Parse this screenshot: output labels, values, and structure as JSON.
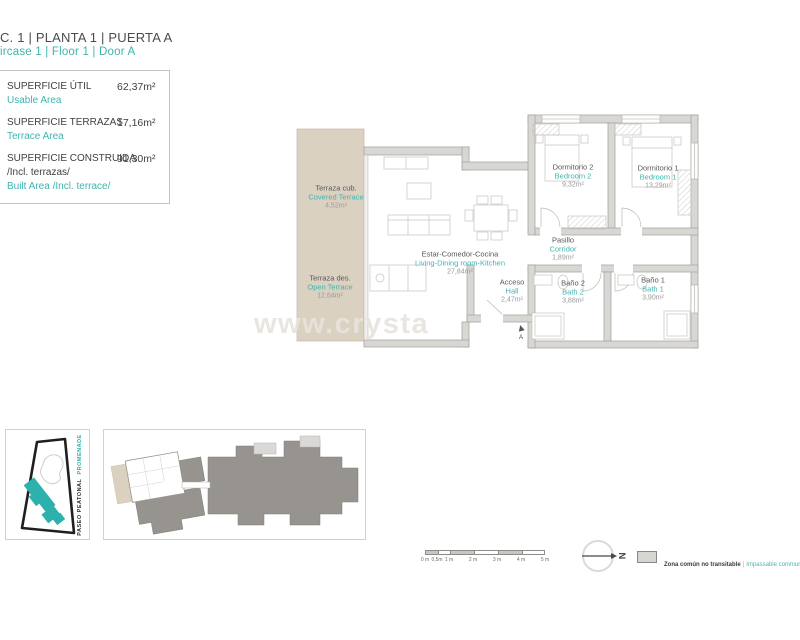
{
  "header": {
    "title_line_es": "C. 1 | PLANTA 1 | PUERTA A",
    "title_line_en": "ircase 1 | Floor 1 | Door A"
  },
  "summary": {
    "rows": [
      {
        "label_es": "SUPERFICIE ÚTIL",
        "label_en": "Usable Area",
        "value": "62,37m²"
      },
      {
        "label_es": "SUPERFICIE TERRAZAS",
        "label_en": "Terrace Area",
        "value": "17,16m²"
      },
      {
        "label_es": "SUPERFICIE CONSTRUIDA",
        "label_es2": "/Incl. terrazas/",
        "label_en": "Built Area /Incl. terrace/",
        "value": "91,30m²"
      }
    ]
  },
  "plan": {
    "rooms": [
      {
        "name_es": "Terraza cub.",
        "name_en": "Covered Terrace",
        "area": "4,52m²"
      },
      {
        "name_es": "Terraza des.",
        "name_en": "Open Terrace",
        "area": "12,64m²"
      },
      {
        "name_es": "Estar-Comedor-Cocina",
        "name_en": "Living-Dining room-Kitchen",
        "area": "27,84m²"
      },
      {
        "name_es": "Dormitorio 2",
        "name_en": "Bedroom 2",
        "area": "9,32m²"
      },
      {
        "name_es": "Dormitorio 1",
        "name_en": "Bedroom 1",
        "area": "13,29m²"
      },
      {
        "name_es": "Pasillo",
        "name_en": "Corridor",
        "area": "1,89m²"
      },
      {
        "name_es": "Acceso",
        "name_en": "Hall",
        "area": "2,47m²"
      },
      {
        "name_es": "Baño 2",
        "name_en": "Bath 2",
        "area": "3,88m²"
      },
      {
        "name_es": "Baño 1",
        "name_en": "Bath 1",
        "area": "3,90m²"
      }
    ],
    "entrance_label": "A"
  },
  "watermark": {
    "text": "www.crysta"
  },
  "site_plan": {
    "street_es": "PASEO PEATONAL",
    "street_en": "PROMENADE"
  },
  "scale_bar": {
    "labels": [
      "0 m",
      "0,5m",
      "1 m",
      "2 m",
      "3 m",
      "4 m",
      "5 m"
    ]
  },
  "north": {
    "label": "N"
  },
  "legend": {
    "label_es": "Zona común no transitable",
    "separator": "|",
    "label_en": "Impassable communal area"
  },
  "colors": {
    "teal": "#3fb4ae",
    "text_dark": "#47484c",
    "area_gray": "#98999d",
    "terrace_beige": "#dbd1c1",
    "wall_fill": "#d9d7d3",
    "wall_stroke": "#a9a7a3",
    "building_mass": "#97948f",
    "footprint_teal": "#2cb1ad"
  }
}
